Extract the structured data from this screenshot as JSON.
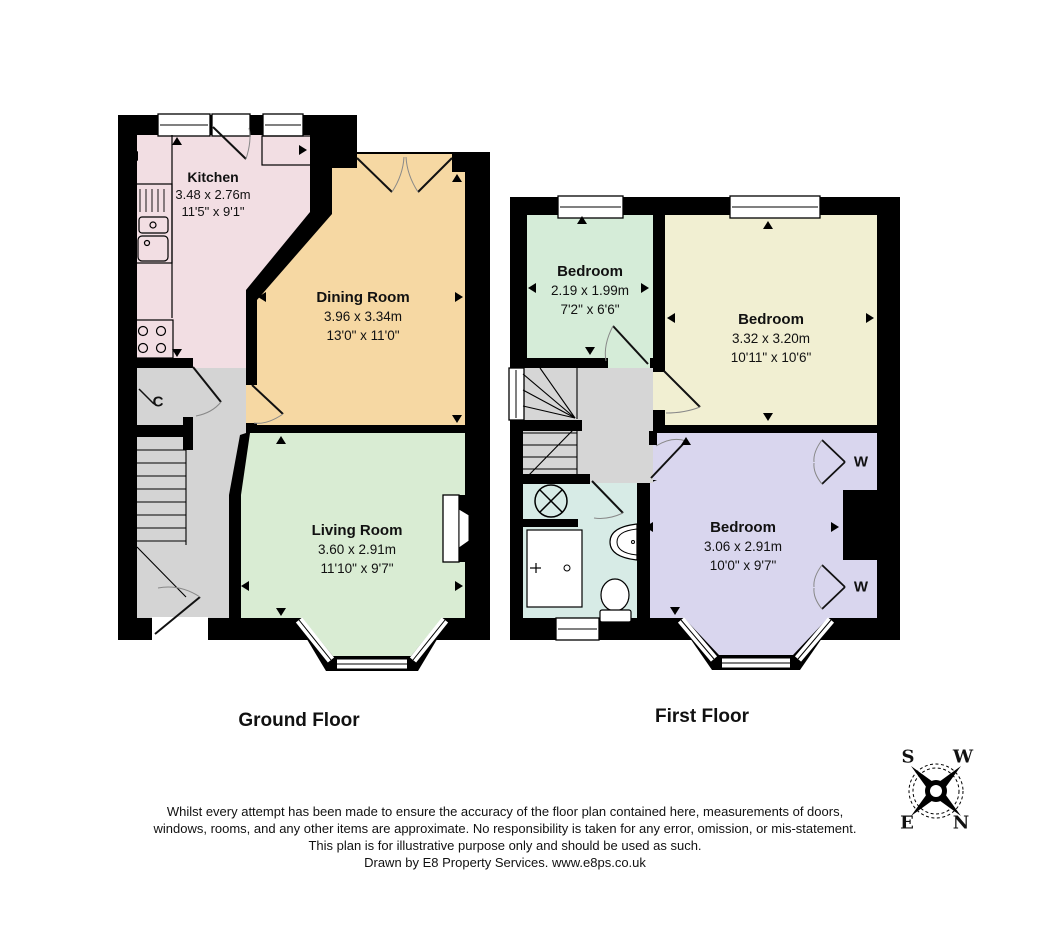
{
  "floor_plan": {
    "ground": {
      "title": "Ground Floor",
      "kitchen": {
        "name": "Kitchen",
        "metric": "3.48 x 2.76m",
        "imperial": "11'5\" x 9'1\""
      },
      "dining_room": {
        "name": "Dining Room",
        "metric": "3.96 x 3.34m",
        "imperial": "13'0\" x 11'0\""
      },
      "living_room": {
        "name": "Living Room",
        "metric": "3.60 x 2.91m",
        "imperial": "11'10\" x 9'7\""
      },
      "cupboard_label": "C"
    },
    "first": {
      "title": "First Floor",
      "bedroom_small": {
        "name": "Bedroom",
        "metric": "2.19 x 1.99m",
        "imperial": "7'2\" x 6'6\""
      },
      "bedroom_rear": {
        "name": "Bedroom",
        "metric": "3.32 x 3.20m",
        "imperial": "10'11\" x 10'6\""
      },
      "bedroom_front": {
        "name": "Bedroom",
        "metric": "3.06 x 2.91m",
        "imperial": "10'0\" x 9'7\""
      },
      "wardrobe_label_top": "W",
      "wardrobe_label_bottom": "W"
    }
  },
  "compass": {
    "s": "S",
    "w": "W",
    "e": "E",
    "n": "N"
  },
  "footer": {
    "lines": [
      "Whilst every attempt has been made to ensure the accuracy of the floor plan contained here, measurements of doors,",
      "windows, rooms, and any other items are approximate. No responsibility is taken for any error, omission, or mis-statement.",
      "This plan is for illustrative purpose only and should be used as such.",
      "Drawn by E8 Property Services. www.e8ps.co.uk"
    ]
  },
  "colors": {
    "wall": "#000000",
    "kitchen": "#f2dee3",
    "dining": "#f6d8a3",
    "living": "#d9ecd3",
    "hall": "#d4d4d4",
    "bedroom_small": "#d5ecd8",
    "bedroom_rear": "#f1efd2",
    "bedroom_front": "#d9d6ee",
    "bathroom": "#d7ebe6",
    "landing": "#d6d6d6",
    "window": "#ffffff"
  }
}
